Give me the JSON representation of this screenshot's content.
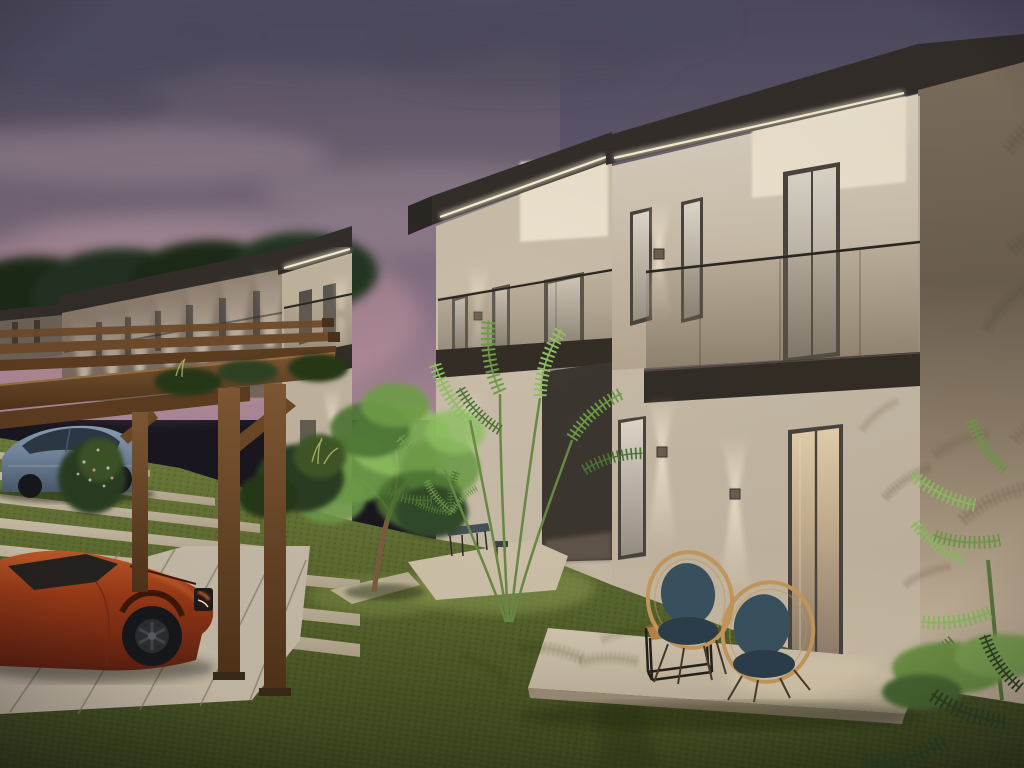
{
  "meta": {
    "title": "Residential complex exterior render at dusk",
    "description": "3D architectural rendering at dusk: a row of two-storey cream stucco townhouses with flat dark roofs, LED strip soffit lighting, glass balconies and up/down wall sconces; timber pergola carport sheltering an orange sports car and a blue sedan; lawn with stepping-stone path, palms, a small tree, and a terrace with two rattan chairs and a cube coffee table under a purple evening sky."
  },
  "palette": {
    "sky_top": "#544e62",
    "sky_mid": "#6e6272",
    "sky_pink": "#9d7f8e",
    "sky_glow": "#c899a3",
    "cloud_dark": "#4e4a5e",
    "cloud_light": "#a38e98",
    "wall_lit": "#d9d0c0",
    "wall_mid": "#c4b7a3",
    "wall_warm": "#efe4d0",
    "wall_shade": "#8a7a6c",
    "roof_dark": "#332e29",
    "led": "#fff4da",
    "frame_dark": "#4a443d",
    "glass_dark": "#8d857a",
    "handrail": "#2b2622",
    "slab_dark": "#332d26",
    "pave": "#c6b9a4",
    "joint": "#857a66",
    "grass_bright": "#7d8c46",
    "grass_mid": "#5d6b30",
    "grass_dark": "#414d22",
    "bush_dark": "#2c3e20",
    "leaf_bright": "#8fbf62",
    "leaf_mid": "#6f9c48",
    "leaf_dark": "#4d7434",
    "palm_dark": "#2f4424",
    "trunk": "#7d5c3e",
    "wood": "#6f4b2b",
    "wood_dark": "#4a3118",
    "car_orange": "#9c3b17",
    "car_blue": "#76879c",
    "tire": "#17181b",
    "rattan": "#c69a5c",
    "cushion": "#3a5260",
    "cushion_dark": "#2c3f4a",
    "metal_dark": "#26211d",
    "table_wood": "#b8854a"
  },
  "scene": {
    "time_of_day": "dusk",
    "objects": [
      "townhouse-row-of-four-units",
      "roof-led-strip-lighting",
      "glass-balconies",
      "up-down-wall-sconces",
      "timber-pergola-carport",
      "orange-sports-car",
      "blue-sedan",
      "stepping-stone-path",
      "concrete-parking-pad",
      "lawn",
      "central-palm-tree",
      "small-garden-tree",
      "flowering-bushes",
      "terrace-with-two-rattan-chairs-and-cube-table",
      "garden-bench",
      "distant-building-wing-with-uplights",
      "background-trees",
      "palm-frond-shadows-on-walls"
    ]
  }
}
